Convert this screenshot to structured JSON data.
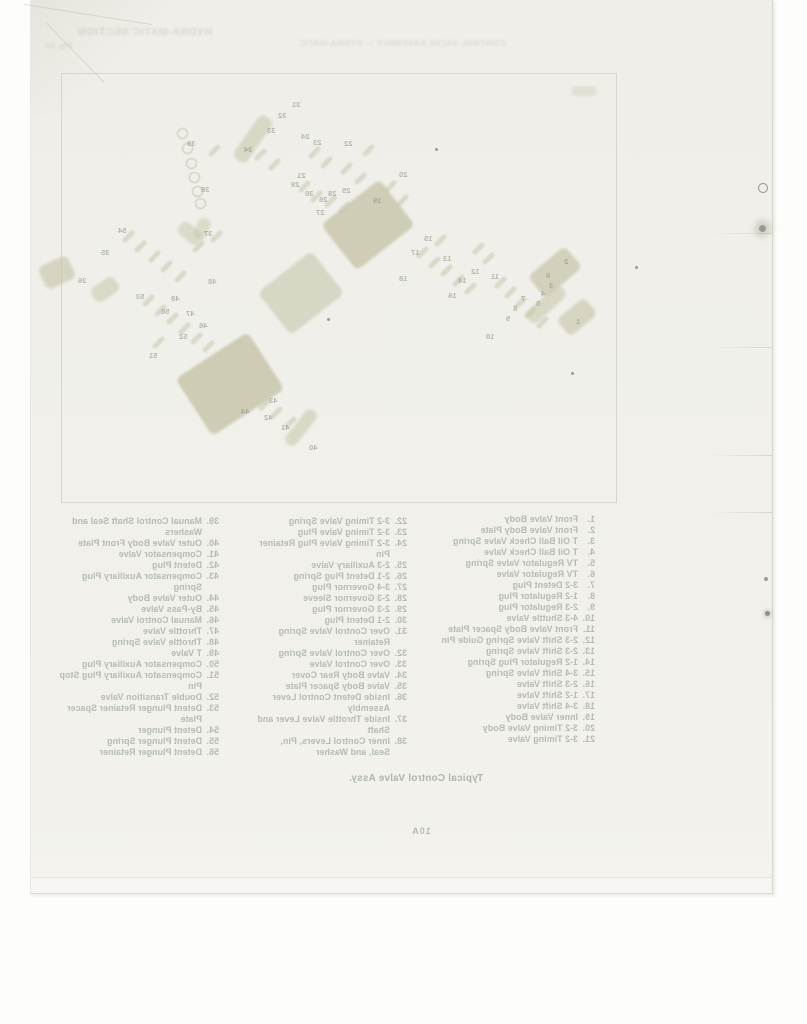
{
  "document": {
    "faint_header_left_line1": "HYDRA-MATIC SECTION",
    "faint_header_left_line2": "Fig. 10",
    "faint_header_center": "CONTROL VALVE ASSEMBLY — HYDRA-MATIC",
    "caption": "Typical Control Valve Assy.",
    "page_number": "10A"
  },
  "parts_list": {
    "columns": [
      {
        "items": [
          {
            "n": "1",
            "lines": [
              "Front Valve Body"
            ]
          },
          {
            "n": "2",
            "lines": [
              "Front Valve Body Plate"
            ]
          },
          {
            "n": "3",
            "lines": [
              "T Oil Ball Check Valve Spring"
            ]
          },
          {
            "n": "4",
            "lines": [
              "T Oil Ball Check Valve"
            ]
          },
          {
            "n": "5",
            "lines": [
              "TV Regulator Valve Spring"
            ]
          },
          {
            "n": "6",
            "lines": [
              "TV Regulator Valve"
            ]
          },
          {
            "n": "7",
            "lines": [
              "3-2 Detent Plug"
            ]
          },
          {
            "n": "8",
            "lines": [
              "1-2 Regulator Plug"
            ]
          },
          {
            "n": "9",
            "lines": [
              "2-3 Regulator Plug"
            ]
          },
          {
            "n": "10",
            "lines": [
              "4-3 Shuttle Valve"
            ]
          },
          {
            "n": "11",
            "lines": [
              "Front Valve Body Spacer Plate"
            ]
          },
          {
            "n": "12",
            "lines": [
              "2-3 Shift Valve Spring Guide Pin"
            ]
          },
          {
            "n": "13",
            "lines": [
              "2-3 Shift Valve Spring"
            ]
          },
          {
            "n": "14",
            "lines": [
              "1-2 Regulator Plug Spring"
            ]
          },
          {
            "n": "15",
            "lines": [
              "3-4 Shift Valve Spring"
            ]
          },
          {
            "n": "16",
            "lines": [
              "2-3 Shift Valve"
            ]
          },
          {
            "n": "17",
            "lines": [
              "1-2 Shift Valve"
            ]
          },
          {
            "n": "18",
            "lines": [
              "3-4 Shift Valve"
            ]
          },
          {
            "n": "19",
            "lines": [
              "Inner Valve Body"
            ]
          },
          {
            "n": "20",
            "lines": [
              "3-2 Timing Valve Body"
            ]
          },
          {
            "n": "21",
            "lines": [
              "3-2 Timing Valve"
            ]
          }
        ]
      },
      {
        "items": [
          {
            "n": "22",
            "lines": [
              "3-2 Timing Valve Spring"
            ]
          },
          {
            "n": "23",
            "lines": [
              "3-2 Timing Valve Plug"
            ]
          },
          {
            "n": "24",
            "lines": [
              "3-2 Timing Valve Plug Retainer",
              "Pin"
            ]
          },
          {
            "n": "25",
            "lines": [
              "2-3 Auxiliary Valve"
            ]
          },
          {
            "n": "26",
            "lines": [
              "2-1 Detent Plug Spring"
            ]
          },
          {
            "n": "27",
            "lines": [
              "3-4 Governor Plug"
            ]
          },
          {
            "n": "28",
            "lines": [
              "2-3 Governor Sleeve"
            ]
          },
          {
            "n": "29",
            "lines": [
              "2-3 Governor Plug"
            ]
          },
          {
            "n": "30",
            "lines": [
              "2-1 Detent Plug"
            ]
          },
          {
            "n": "31",
            "lines": [
              "Over Control Valve Spring",
              "Retainer"
            ]
          },
          {
            "n": "32",
            "lines": [
              "Over Control Valve Spring"
            ]
          },
          {
            "n": "33",
            "lines": [
              "Over Control Valve"
            ]
          },
          {
            "n": "34",
            "lines": [
              "Valve Body Rear Cover"
            ]
          },
          {
            "n": "35",
            "lines": [
              "Valve Body Spacer Plate"
            ]
          },
          {
            "n": "36",
            "lines": [
              "Inside Detent Control Lever",
              "Assembly"
            ]
          },
          {
            "n": "37",
            "lines": [
              "Inside Throttle Valve Lever and",
              "Shaft"
            ]
          },
          {
            "n": "38",
            "lines": [
              "Inner Control Levers, Pin,",
              "Seal, and Washer"
            ]
          }
        ]
      },
      {
        "items": [
          {
            "n": "39",
            "lines": [
              "Manual Control Shaft Seal and",
              "Washers"
            ]
          },
          {
            "n": "40",
            "lines": [
              "Outer Valve Body Front Plate"
            ]
          },
          {
            "n": "41",
            "lines": [
              "Compensator Valve"
            ]
          },
          {
            "n": "42",
            "lines": [
              "Detent Plug"
            ]
          },
          {
            "n": "43",
            "lines": [
              "Compensator Auxiliary Plug",
              "Spring"
            ]
          },
          {
            "n": "44",
            "lines": [
              "Outer Valve Body"
            ]
          },
          {
            "n": "45",
            "lines": [
              "By-Pass Valve"
            ]
          },
          {
            "n": "46",
            "lines": [
              "Manual Control Valve"
            ]
          },
          {
            "n": "47",
            "lines": [
              "Throttle Valve"
            ]
          },
          {
            "n": "48",
            "lines": [
              "Throttle Valve Spring"
            ]
          },
          {
            "n": "49",
            "lines": [
              "T Valve"
            ]
          },
          {
            "n": "50",
            "lines": [
              "Compensator Auxiliary Plug"
            ]
          },
          {
            "n": "51",
            "lines": [
              "Compensator Auxiliary Plug Stop",
              "Pin"
            ]
          },
          {
            "n": "52",
            "lines": [
              "Double Transition Valve"
            ]
          },
          {
            "n": "53",
            "lines": [
              "Detent Plunger Retainer Spacer",
              "Plate"
            ]
          },
          {
            "n": "54",
            "lines": [
              "Detent Plunger"
            ]
          },
          {
            "n": "55",
            "lines": [
              "Detent Plunger Spring"
            ]
          },
          {
            "n": "56",
            "lines": [
              "Detent Plunger Retainer"
            ]
          }
        ]
      }
    ]
  },
  "diagram": {
    "labels": [
      {
        "n": "31",
        "x": 261,
        "y": 100
      },
      {
        "n": "32",
        "x": 247,
        "y": 111
      },
      {
        "n": "33",
        "x": 236,
        "y": 126
      },
      {
        "n": "34",
        "x": 213,
        "y": 145
      },
      {
        "n": "22",
        "x": 313,
        "y": 139
      },
      {
        "n": "23",
        "x": 282,
        "y": 138
      },
      {
        "n": "24",
        "x": 270,
        "y": 132
      },
      {
        "n": "21",
        "x": 266,
        "y": 171
      },
      {
        "n": "20",
        "x": 368,
        "y": 170
      },
      {
        "n": "19",
        "x": 342,
        "y": 196
      },
      {
        "n": "25",
        "x": 311,
        "y": 186
      },
      {
        "n": "26",
        "x": 288,
        "y": 195
      },
      {
        "n": "27",
        "x": 285,
        "y": 208
      },
      {
        "n": "28",
        "x": 297,
        "y": 189
      },
      {
        "n": "29",
        "x": 260,
        "y": 180
      },
      {
        "n": "30",
        "x": 274,
        "y": 189
      },
      {
        "n": "38",
        "x": 170,
        "y": 185
      },
      {
        "n": "39",
        "x": 156,
        "y": 139
      },
      {
        "n": "37",
        "x": 173,
        "y": 229
      },
      {
        "n": "36",
        "x": 47,
        "y": 276
      },
      {
        "n": "35",
        "x": 70,
        "y": 248
      },
      {
        "n": "54",
        "x": 87,
        "y": 226
      },
      {
        "n": "53",
        "x": 105,
        "y": 292
      },
      {
        "n": "49",
        "x": 140,
        "y": 294
      },
      {
        "n": "48",
        "x": 177,
        "y": 277
      },
      {
        "n": "46",
        "x": 168,
        "y": 321
      },
      {
        "n": "52",
        "x": 148,
        "y": 332
      },
      {
        "n": "51",
        "x": 118,
        "y": 351
      },
      {
        "n": "47",
        "x": 155,
        "y": 309
      },
      {
        "n": "50",
        "x": 130,
        "y": 307
      },
      {
        "n": "44",
        "x": 210,
        "y": 407
      },
      {
        "n": "43",
        "x": 238,
        "y": 396
      },
      {
        "n": "42",
        "x": 233,
        "y": 413
      },
      {
        "n": "41",
        "x": 250,
        "y": 423
      },
      {
        "n": "40",
        "x": 278,
        "y": 443
      },
      {
        "n": "18",
        "x": 368,
        "y": 274
      },
      {
        "n": "15",
        "x": 393,
        "y": 234
      },
      {
        "n": "17",
        "x": 380,
        "y": 248
      },
      {
        "n": "16",
        "x": 417,
        "y": 291
      },
      {
        "n": "13",
        "x": 412,
        "y": 254
      },
      {
        "n": "12",
        "x": 440,
        "y": 267
      },
      {
        "n": "14",
        "x": 427,
        "y": 276
      },
      {
        "n": "11",
        "x": 460,
        "y": 272
      },
      {
        "n": "10",
        "x": 455,
        "y": 332
      },
      {
        "n": "2",
        "x": 533,
        "y": 257
      },
      {
        "n": "3",
        "x": 518,
        "y": 281
      },
      {
        "n": "1",
        "x": 545,
        "y": 317
      },
      {
        "n": "4",
        "x": 510,
        "y": 289
      },
      {
        "n": "5",
        "x": 505,
        "y": 299
      },
      {
        "n": "6",
        "x": 515,
        "y": 271
      },
      {
        "n": "7",
        "x": 490,
        "y": 294
      },
      {
        "n": "8",
        "x": 482,
        "y": 304
      },
      {
        "n": "9",
        "x": 475,
        "y": 314
      }
    ],
    "blobs": [
      {
        "x": 300,
        "y": 196,
        "w": 74,
        "h": 58,
        "r": -38,
        "c": "#c7c5a9",
        "o": 0.8
      },
      {
        "x": 236,
        "y": 266,
        "w": 68,
        "h": 54,
        "r": -38,
        "c": "#c9cbb2",
        "o": 0.65
      },
      {
        "x": 156,
        "y": 350,
        "w": 86,
        "h": 68,
        "r": -33,
        "c": "#c3c0a2",
        "o": 0.75
      },
      {
        "x": 196,
        "y": 131,
        "w": 52,
        "h": 16,
        "r": -55,
        "c": "#cbc9ae",
        "o": 0.6
      },
      {
        "x": 249,
        "y": 421,
        "w": 42,
        "h": 13,
        "r": -52,
        "c": "#cbc9ae",
        "o": 0.6
      },
      {
        "x": 500,
        "y": 258,
        "w": 48,
        "h": 28,
        "r": -40,
        "c": "#c7c4a8",
        "o": 0.7
      },
      {
        "x": 492,
        "y": 297,
        "w": 46,
        "h": 15,
        "r": -42,
        "c": "#cbc9ae",
        "o": 0.6
      },
      {
        "x": 528,
        "y": 306,
        "w": 36,
        "h": 22,
        "r": -40,
        "c": "#c7c4a8",
        "o": 0.6
      },
      {
        "x": 10,
        "y": 260,
        "w": 32,
        "h": 25,
        "r": -25,
        "c": "#c6c3a8",
        "o": 0.6
      },
      {
        "x": 60,
        "y": 281,
        "w": 28,
        "h": 17,
        "r": -35,
        "c": "#c9c7ac",
        "o": 0.55
      },
      {
        "x": 146,
        "y": 226,
        "w": 26,
        "h": 15,
        "r": 40,
        "c": "#c9c7ac",
        "o": 0.5
      },
      {
        "x": 160,
        "y": 222,
        "w": 22,
        "h": 13,
        "r": -65,
        "c": "#c9c7ac",
        "o": 0.5
      },
      {
        "x": 540,
        "y": 86,
        "w": 26,
        "h": 10,
        "r": 0,
        "c": "#d4d3c2",
        "o": 0.5
      }
    ],
    "pills": [
      [
        222,
        152
      ],
      [
        236,
        162
      ],
      [
        276,
        150
      ],
      [
        288,
        160
      ],
      [
        308,
        166
      ],
      [
        322,
        176
      ],
      [
        266,
        184
      ],
      [
        278,
        194
      ],
      [
        292,
        199
      ],
      [
        306,
        205
      ],
      [
        352,
        184
      ],
      [
        364,
        198
      ],
      [
        330,
        148
      ],
      [
        176,
        148
      ],
      [
        384,
        250
      ],
      [
        396,
        260
      ],
      [
        408,
        268
      ],
      [
        420,
        278
      ],
      [
        432,
        286
      ],
      [
        402,
        238
      ],
      [
        462,
        280
      ],
      [
        472,
        290
      ],
      [
        482,
        300
      ],
      [
        492,
        310
      ],
      [
        504,
        320
      ],
      [
        90,
        234
      ],
      [
        102,
        244
      ],
      [
        116,
        254
      ],
      [
        128,
        264
      ],
      [
        142,
        274
      ],
      [
        110,
        298
      ],
      [
        122,
        308
      ],
      [
        134,
        316
      ],
      [
        146,
        326
      ],
      [
        158,
        336
      ],
      [
        170,
        344
      ],
      [
        120,
        340
      ],
      [
        226,
        402
      ],
      [
        238,
        410
      ],
      [
        252,
        420
      ],
      [
        178,
        234
      ],
      [
        160,
        244
      ],
      [
        440,
        246
      ],
      [
        450,
        256
      ]
    ],
    "rings": [
      [
        146,
        128
      ],
      [
        151,
        143
      ],
      [
        155,
        158
      ],
      [
        158,
        172
      ],
      [
        161,
        186
      ],
      [
        164,
        198
      ]
    ],
    "specks": [
      [
        404,
        148
      ],
      [
        296,
        318
      ],
      [
        540,
        372
      ],
      [
        604,
        266
      ]
    ],
    "binder_marks": [
      {
        "type": "ring",
        "x": 727,
        "y": 183
      },
      {
        "type": "blot",
        "x": 728,
        "y": 225
      },
      {
        "type": "dot",
        "x": 733,
        "y": 577
      },
      {
        "type": "dot2",
        "x": 734,
        "y": 611
      }
    ]
  }
}
